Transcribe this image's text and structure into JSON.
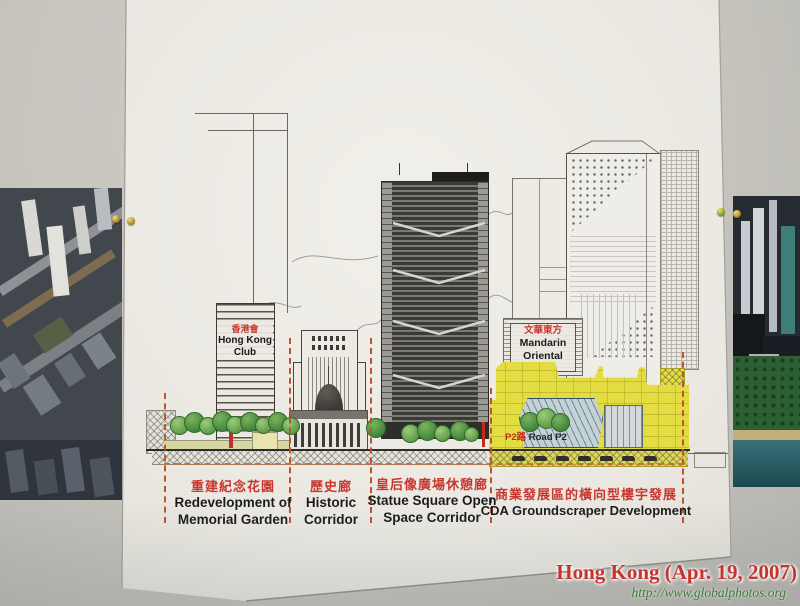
{
  "watermark": {
    "title": "Hong Kong (Apr. 19, 2007)",
    "url": "http://www.globalphotos.org"
  },
  "diagram": {
    "zones": [
      {
        "zh": "重建紀念花園",
        "en_line1": "Redevelopment of",
        "en_line2": "Memorial Garden"
      },
      {
        "zh": "歷史廊",
        "en_line1": "Historic",
        "en_line2": "Corridor"
      },
      {
        "zh": "皇后像廣場休憩廊",
        "en_line1": "Statue Square Open",
        "en_line2": "Space Corridor"
      },
      {
        "zh": "商業發展區的橫向型樓宇發展",
        "en_line1": "CDA Groundscraper Development"
      }
    ],
    "buildings": {
      "hong_kong_club": {
        "zh": "香港會",
        "en_line1": "Hong Kong",
        "en_line2": "Club"
      },
      "mandarin_oriental": {
        "zh": "文華東方",
        "en_line1": "Mandarin",
        "en_line2": "Oriental"
      }
    },
    "road_p2": {
      "zh": "P2路 ",
      "en": "Road P2"
    }
  },
  "colors": {
    "cda_highlight_yellow": "#e4dd42",
    "tree_green": "#6faf58",
    "label_red": "#c8372e",
    "zone_dash_orange": "#bd5430",
    "watermark_red": "#c43530",
    "watermark_url_green": "#3d7a33"
  }
}
